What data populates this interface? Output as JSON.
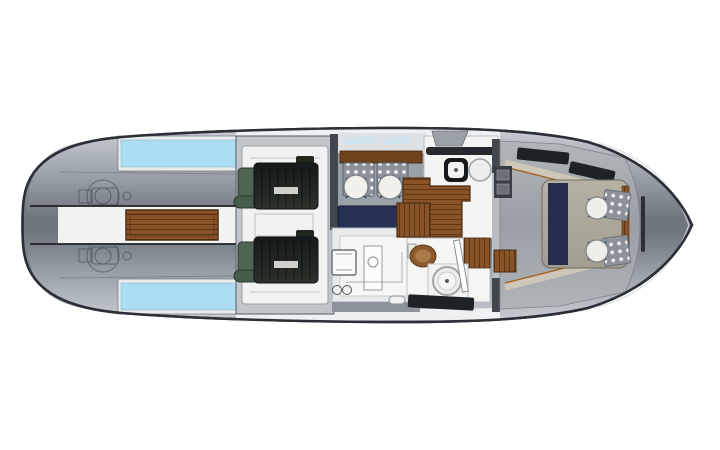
{
  "scene": {
    "type": "yacht-deck-plan",
    "description": "Top-down interior deck plan rendering of a motor yacht hull on a white background, bow pointing right, rounded transom at left. No text labels are visible in the image.",
    "background": "#ffffff"
  },
  "palette": {
    "hull_outline": "#2c3036",
    "gunwale_white": "#eef0f1",
    "skylight_blue": "#aadcf2",
    "skylight_frame": "#e9ebec",
    "walkway_white": "#f2f2f0",
    "teak": "#8a5327",
    "teak_dark": "#5c3717",
    "teak_border": "#4a2d12",
    "engine_green": "#4f6455",
    "engine_green_dark": "#465c4d",
    "engine_room_floor": "#f1f2f1",
    "engine_room_wall": "#c2c6cb",
    "bulkhead_dark": "#42474e",
    "dinette_floor": "#9aa1a9",
    "wood_shelf": "#6f421c",
    "seat_gray": "#8b929a",
    "seat_dot": "#eef0f0",
    "navy_upholstery": "#273055",
    "counter_white": "#f4f4f2",
    "fiddle_black": "#26292d",
    "sink_black": "#17191c",
    "head_floor": "#f6f6f4",
    "toilet_wood": "#8a5a2e",
    "window_dark": "#1e2126",
    "bed_runner_navy": "#272e4d",
    "tan_trim": "#d2cbba",
    "wood_trim": "#a8662a",
    "utility_floor": "#e9eaea",
    "fixture_outline": "#51565c",
    "side_deck_gray": "#8d939a",
    "dresser_dark": "#3a3f45"
  },
  "regions": {
    "aft_deck": {
      "label": "Aft deck with hatches, skylights and teak walkway"
    },
    "engine_room": {
      "label": "Engine room with twin engines"
    },
    "dinette": {
      "label": "Dinette with two round tables, stools and navy settee"
    },
    "galley": {
      "label": "Galley counter with square sink and round basin"
    },
    "utility_room": {
      "label": "Lower utility galley with appliance outlines"
    },
    "head": {
      "label": "Head with round sink and wooden toilet"
    },
    "forward_cabin": {
      "label": "Forward master cabin with double berth and navy runner"
    },
    "foredeck": {
      "label": "Foredeck with anchor locker line"
    }
  }
}
